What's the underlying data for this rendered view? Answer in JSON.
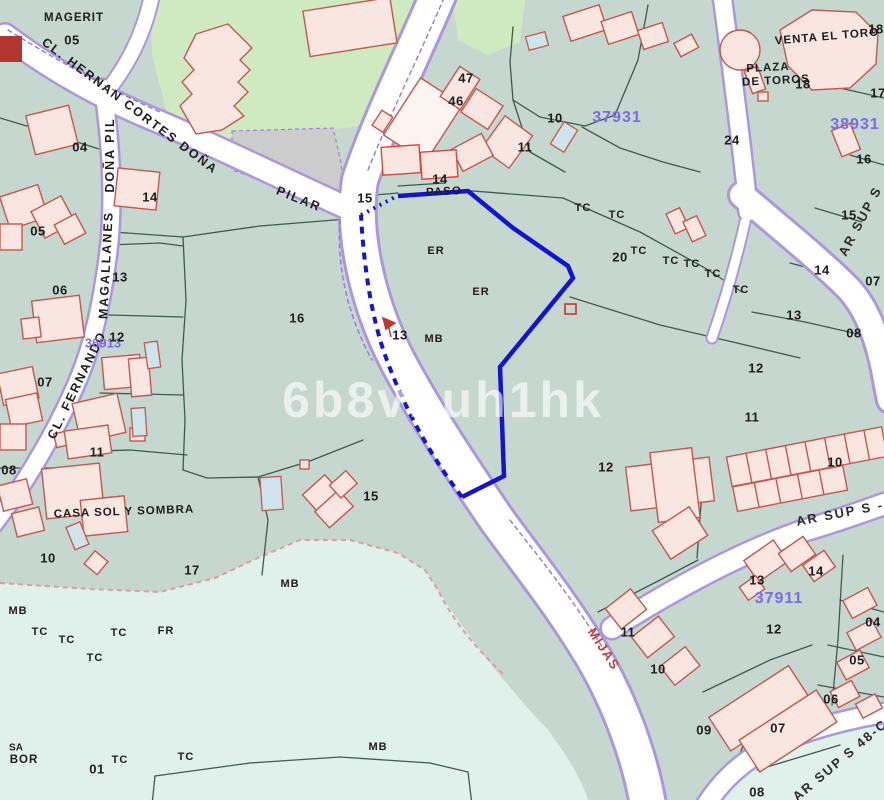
{
  "map": {
    "colors": {
      "background": "#c6d7cf",
      "pale_zone": "#dff1ea",
      "green_zone": "#cfe9c1",
      "grey_zone": "#cbcccb",
      "road_fill": "#ffffff",
      "road_border": "#ab97dc",
      "parcel_line": "#3e5a4e",
      "building_fill": "#f9e6e0",
      "building_stroke": "#c4574e",
      "pool_fill": "#cfe4ea",
      "selection_blue": "#1414cf",
      "block_code_purple": "#7d6be0",
      "red_accent": "#c0392f"
    },
    "watermark": "6b8vbuh1hk",
    "labels": [
      {
        "name": "place-magerit",
        "text": "MAGERIT",
        "x": 74,
        "y": 18,
        "rot": 0,
        "cls": "place"
      },
      {
        "name": "parcel-number-05-magerit",
        "text": "05",
        "x": 72,
        "y": 40,
        "rot": 0,
        "cls": "num"
      },
      {
        "name": "street-name-hernan-cortes",
        "text": "CL. HERNAN CORTES DOÑA",
        "x": 130,
        "y": 106,
        "rot": 37,
        "cls": "street"
      },
      {
        "name": "street-name-pilar",
        "text": "PILAR",
        "x": 299,
        "y": 199,
        "rot": 22,
        "cls": "street"
      },
      {
        "name": "street-name-dona-pil",
        "text": "DOÑA PIL",
        "x": 110,
        "y": 155,
        "rot": -90,
        "cls": "street"
      },
      {
        "name": "street-name-magallanes",
        "text": "MAGALLANES",
        "x": 106,
        "y": 265,
        "rot": -87,
        "cls": "street"
      },
      {
        "name": "street-name-fernando",
        "text": "CL. FERNANDO",
        "x": 77,
        "y": 385,
        "rot": -64,
        "cls": "street"
      },
      {
        "name": "place-paso",
        "text": "PASO",
        "x": 444,
        "y": 192,
        "rot": -3,
        "cls": "place"
      },
      {
        "name": "place-venta-el-toro",
        "text": "VENTA EL TORO",
        "x": 827,
        "y": 37,
        "rot": -5,
        "cls": "place"
      },
      {
        "name": "place-plaza-line1",
        "text": "PLAZA",
        "x": 768,
        "y": 68,
        "rot": -3,
        "cls": "place"
      },
      {
        "name": "place-plaza-line2",
        "text": "DE TOROS",
        "x": 776,
        "y": 81,
        "rot": -3,
        "cls": "place"
      },
      {
        "name": "place-casa-sol-y-sombra",
        "text": "CASA SOL Y SOMBRA",
        "x": 124,
        "y": 512,
        "rot": -2,
        "cls": "place"
      },
      {
        "name": "street-name-mijas",
        "text": "MIJAS",
        "x": 604,
        "y": 649,
        "rot": 57,
        "cls": "street-red"
      },
      {
        "name": "street-name-ar-sup-s-upper",
        "text": "AR SUP S",
        "x": 860,
        "y": 221,
        "rot": -62,
        "cls": "street-dark"
      },
      {
        "name": "street-name-ar-sup-s-mid",
        "text": "AR SUP S -",
        "x": 840,
        "y": 513,
        "rot": -11,
        "cls": "street-dark"
      },
      {
        "name": "street-name-ar-sup-s-48",
        "text": "AR SUP S 48-C",
        "x": 840,
        "y": 760,
        "rot": -40,
        "cls": "street-dark"
      },
      {
        "name": "place-bor-line1",
        "text": "SA",
        "x": 16,
        "y": 748,
        "rot": 0,
        "cls": "small"
      },
      {
        "name": "place-bor-line2",
        "text": "BOR",
        "x": 24,
        "y": 760,
        "rot": 0,
        "cls": "place"
      },
      {
        "name": "block-code-37931",
        "text": "37931",
        "x": 617,
        "y": 118,
        "rot": 0,
        "cls": "code"
      },
      {
        "name": "block-code-38931",
        "text": "38931",
        "x": 855,
        "y": 125,
        "rot": 0,
        "cls": "code"
      },
      {
        "name": "block-code-37911",
        "text": "37911",
        "x": 779,
        "y": 599,
        "rot": 0,
        "cls": "code"
      },
      {
        "name": "block-code-36913",
        "text": "36913",
        "x": 103,
        "y": 343,
        "rot": 0,
        "cls": "code-sm"
      },
      {
        "name": "parcel-number-04",
        "text": "04",
        "x": 80,
        "y": 147,
        "rot": 0,
        "cls": "num"
      },
      {
        "name": "parcel-number-14-left",
        "text": "14",
        "x": 150,
        "y": 197,
        "rot": 0,
        "cls": "num"
      },
      {
        "name": "parcel-number-05-left",
        "text": "05",
        "x": 38,
        "y": 231,
        "rot": 0,
        "cls": "num"
      },
      {
        "name": "parcel-number-06",
        "text": "06",
        "x": 60,
        "y": 290,
        "rot": 0,
        "cls": "num"
      },
      {
        "name": "parcel-number-13-left",
        "text": "13",
        "x": 120,
        "y": 277,
        "rot": 0,
        "cls": "num"
      },
      {
        "name": "parcel-number-12-left",
        "text": "12",
        "x": 117,
        "y": 337,
        "rot": 0,
        "cls": "num"
      },
      {
        "name": "parcel-number-07-left",
        "text": "07",
        "x": 45,
        "y": 382,
        "rot": 0,
        "cls": "num"
      },
      {
        "name": "parcel-number-11-left",
        "text": "11",
        "x": 97,
        "y": 452,
        "rot": 0,
        "cls": "num"
      },
      {
        "name": "parcel-number-08-left",
        "text": "08",
        "x": 9,
        "y": 470,
        "rot": 0,
        "cls": "num"
      },
      {
        "name": "parcel-number-10-left",
        "text": "10",
        "x": 48,
        "y": 558,
        "rot": 0,
        "cls": "num"
      },
      {
        "name": "parcel-number-17",
        "text": "17",
        "x": 192,
        "y": 570,
        "rot": 0,
        "cls": "num"
      },
      {
        "name": "parcel-number-16-center",
        "text": "16",
        "x": 297,
        "y": 318,
        "rot": 0,
        "cls": "num"
      },
      {
        "name": "parcel-number-15-center",
        "text": "15",
        "x": 371,
        "y": 496,
        "rot": 0,
        "cls": "num"
      },
      {
        "name": "parcel-number-15-road",
        "text": "15",
        "x": 365,
        "y": 198,
        "rot": 0,
        "cls": "num"
      },
      {
        "name": "parcel-number-14-paso",
        "text": "14",
        "x": 440,
        "y": 179,
        "rot": 0,
        "cls": "num"
      },
      {
        "name": "parcel-number-47",
        "text": "47",
        "x": 466,
        "y": 78,
        "rot": 0,
        "cls": "num"
      },
      {
        "name": "parcel-number-46",
        "text": "46",
        "x": 456,
        "y": 101,
        "rot": 0,
        "cls": "num"
      },
      {
        "name": "parcel-number-10-top",
        "text": "10",
        "x": 555,
        "y": 118,
        "rot": 0,
        "cls": "num"
      },
      {
        "name": "parcel-number-11-top",
        "text": "11",
        "x": 525,
        "y": 147,
        "rot": 0,
        "cls": "num"
      },
      {
        "name": "parcel-number-24",
        "text": "24",
        "x": 732,
        "y": 140,
        "rot": 0,
        "cls": "num"
      },
      {
        "name": "parcel-number-18-corner",
        "text": "18",
        "x": 876,
        "y": 29,
        "rot": 0,
        "cls": "num"
      },
      {
        "name": "parcel-number-18-right",
        "text": "18",
        "x": 803,
        "y": 84,
        "rot": 0,
        "cls": "num"
      },
      {
        "name": "parcel-number-17-right",
        "text": "17",
        "x": 878,
        "y": 93,
        "rot": 0,
        "cls": "num"
      },
      {
        "name": "parcel-number-16-right",
        "text": "16",
        "x": 864,
        "y": 159,
        "rot": 0,
        "cls": "num"
      },
      {
        "name": "parcel-number-15-right",
        "text": "15",
        "x": 849,
        "y": 215,
        "rot": 0,
        "cls": "num"
      },
      {
        "name": "parcel-number-14-right",
        "text": "14",
        "x": 822,
        "y": 270,
        "rot": 0,
        "cls": "num"
      },
      {
        "name": "parcel-number-07-right",
        "text": "07",
        "x": 873,
        "y": 281,
        "rot": 0,
        "cls": "num"
      },
      {
        "name": "parcel-number-13-right",
        "text": "13",
        "x": 794,
        "y": 315,
        "rot": 0,
        "cls": "num"
      },
      {
        "name": "parcel-number-08-right",
        "text": "08",
        "x": 854,
        "y": 333,
        "rot": 0,
        "cls": "num"
      },
      {
        "name": "parcel-number-20",
        "text": "20",
        "x": 620,
        "y": 257,
        "rot": 0,
        "cls": "num"
      },
      {
        "name": "parcel-number-11-right",
        "text": "11",
        "x": 752,
        "y": 417,
        "rot": 0,
        "cls": "num"
      },
      {
        "name": "parcel-number-12-right",
        "text": "12",
        "x": 756,
        "y": 368,
        "rot": 0,
        "cls": "num"
      },
      {
        "name": "parcel-number-10-terrace",
        "text": "10",
        "x": 835,
        "y": 462,
        "rot": 0,
        "cls": "num"
      },
      {
        "name": "parcel-number-12-big",
        "text": "12",
        "x": 606,
        "y": 467,
        "rot": 0,
        "cls": "num"
      },
      {
        "name": "parcel-number-13-mark",
        "text": "13",
        "x": 400,
        "y": 335,
        "rot": 0,
        "cls": "num"
      },
      {
        "name": "parcel-number-11-bottom",
        "text": "11",
        "x": 628,
        "y": 632,
        "rot": 0,
        "cls": "num"
      },
      {
        "name": "parcel-number-10-bottom",
        "text": "10",
        "x": 658,
        "y": 669,
        "rot": 0,
        "cls": "num"
      },
      {
        "name": "parcel-number-13-se",
        "text": "13",
        "x": 757,
        "y": 580,
        "rot": 0,
        "cls": "num"
      },
      {
        "name": "parcel-number-14-se",
        "text": "14",
        "x": 816,
        "y": 571,
        "rot": 0,
        "cls": "num"
      },
      {
        "name": "parcel-number-12-se",
        "text": "12",
        "x": 774,
        "y": 629,
        "rot": 0,
        "cls": "num"
      },
      {
        "name": "parcel-number-04-se",
        "text": "04",
        "x": 873,
        "y": 622,
        "rot": 0,
        "cls": "num"
      },
      {
        "name": "parcel-number-05-se",
        "text": "05",
        "x": 857,
        "y": 660,
        "rot": 0,
        "cls": "num"
      },
      {
        "name": "parcel-number-06-se",
        "text": "06",
        "x": 831,
        "y": 699,
        "rot": 0,
        "cls": "num"
      },
      {
        "name": "parcel-number-07-se",
        "text": "07",
        "x": 778,
        "y": 728,
        "rot": 0,
        "cls": "num"
      },
      {
        "name": "parcel-number-09-se",
        "text": "09",
        "x": 704,
        "y": 730,
        "rot": 0,
        "cls": "num"
      },
      {
        "name": "parcel-number-08-se",
        "text": "08",
        "x": 757,
        "y": 792,
        "rot": 0,
        "cls": "num"
      },
      {
        "name": "parcel-number-01",
        "text": "01",
        "x": 97,
        "y": 769,
        "rot": 0,
        "cls": "num"
      },
      {
        "name": "landuse-er-1",
        "text": "ER",
        "x": 436,
        "y": 251,
        "rot": 0,
        "cls": "lu"
      },
      {
        "name": "landuse-er-2",
        "text": "ER",
        "x": 481,
        "y": 292,
        "rot": 0,
        "cls": "lu"
      },
      {
        "name": "landuse-mb-1",
        "text": "MB",
        "x": 434,
        "y": 339,
        "rot": 0,
        "cls": "lu"
      },
      {
        "name": "landuse-mb-2",
        "text": "MB",
        "x": 290,
        "y": 584,
        "rot": 0,
        "cls": "lu"
      },
      {
        "name": "landuse-mb-3",
        "text": "MB",
        "x": 18,
        "y": 611,
        "rot": 0,
        "cls": "lu"
      },
      {
        "name": "landuse-mb-4",
        "text": "MB",
        "x": 378,
        "y": 747,
        "rot": 0,
        "cls": "lu"
      },
      {
        "name": "landuse-fr",
        "text": "FR",
        "x": 166,
        "y": 631,
        "rot": 0,
        "cls": "lu"
      },
      {
        "name": "landuse-tc-1",
        "text": "TC",
        "x": 583,
        "y": 208,
        "rot": 0,
        "cls": "lu"
      },
      {
        "name": "landuse-tc-2",
        "text": "TC",
        "x": 617,
        "y": 215,
        "rot": 0,
        "cls": "lu"
      },
      {
        "name": "landuse-tc-3",
        "text": "TC",
        "x": 639,
        "y": 251,
        "rot": 0,
        "cls": "lu"
      },
      {
        "name": "landuse-tc-4",
        "text": "TC",
        "x": 671,
        "y": 261,
        "rot": 0,
        "cls": "lu"
      },
      {
        "name": "landuse-tc-5",
        "text": "TC",
        "x": 692,
        "y": 264,
        "rot": 0,
        "cls": "lu"
      },
      {
        "name": "landuse-tc-6",
        "text": "TC",
        "x": 713,
        "y": 274,
        "rot": 0,
        "cls": "lu"
      },
      {
        "name": "landuse-tc-7",
        "text": "TC",
        "x": 741,
        "y": 290,
        "rot": 0,
        "cls": "lu"
      },
      {
        "name": "landuse-tc-8",
        "text": "TC",
        "x": 40,
        "y": 632,
        "rot": 0,
        "cls": "lu"
      },
      {
        "name": "landuse-tc-9",
        "text": "TC",
        "x": 67,
        "y": 640,
        "rot": 0,
        "cls": "lu"
      },
      {
        "name": "landuse-tc-10",
        "text": "TC",
        "x": 119,
        "y": 633,
        "rot": 0,
        "cls": "lu"
      },
      {
        "name": "landuse-tc-11",
        "text": "TC",
        "x": 95,
        "y": 658,
        "rot": 0,
        "cls": "lu"
      },
      {
        "name": "landuse-tc-12",
        "text": "TC",
        "x": 120,
        "y": 760,
        "rot": 0,
        "cls": "lu"
      },
      {
        "name": "landuse-tc-13",
        "text": "TC",
        "x": 186,
        "y": 757,
        "rot": 0,
        "cls": "lu"
      },
      {
        "name": "watermark-text",
        "text": "6b8vbuh1hk",
        "x": 443,
        "y": 400,
        "rot": 0,
        "cls": "watermark"
      }
    ]
  }
}
